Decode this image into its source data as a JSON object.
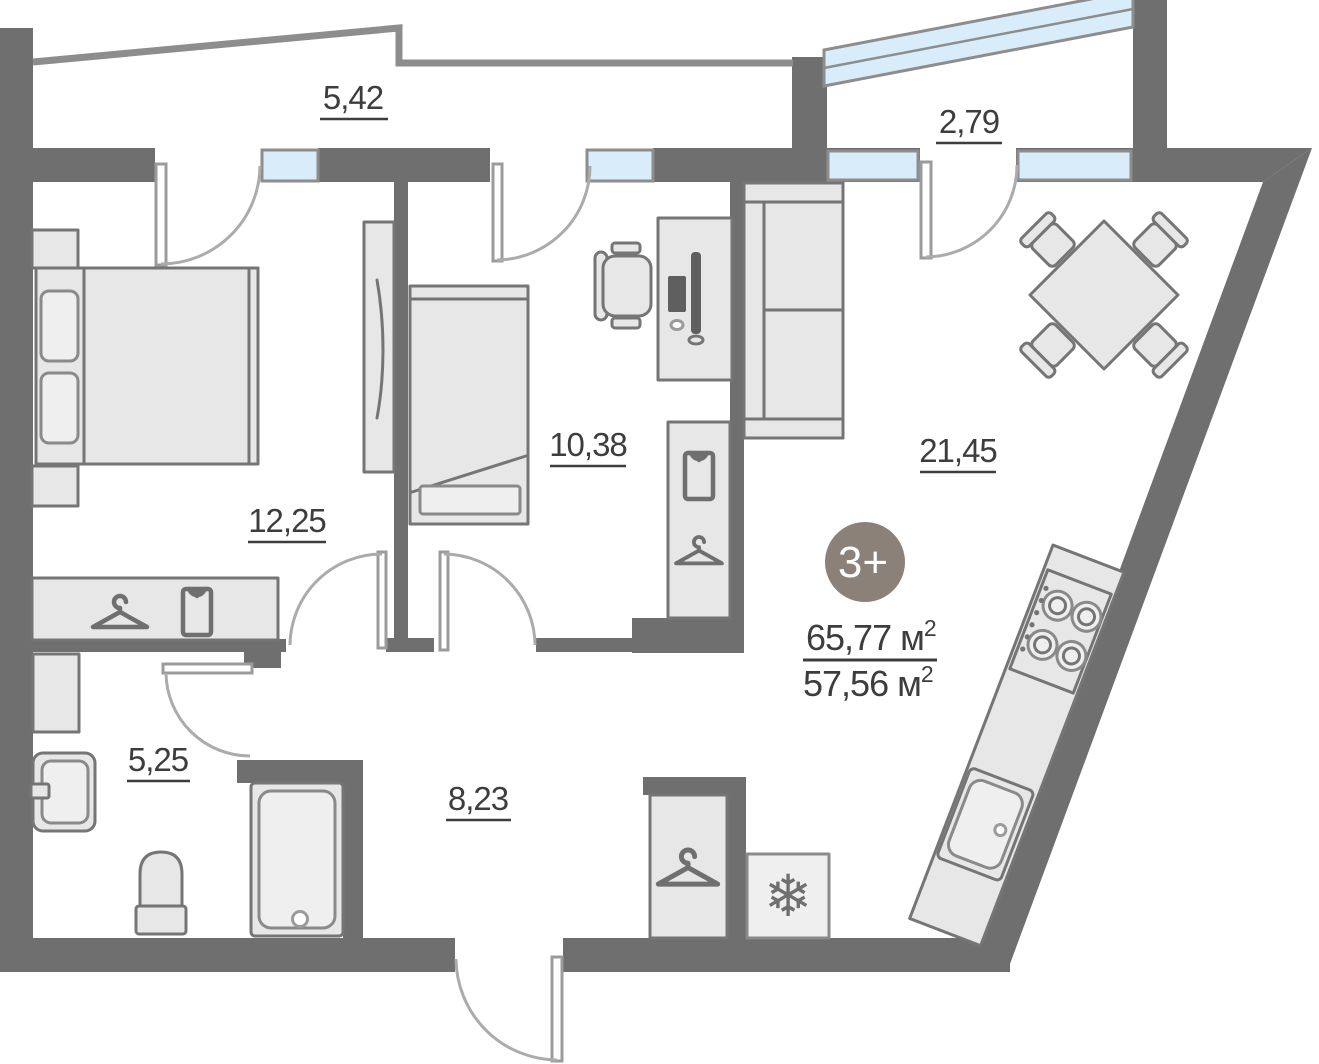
{
  "plan": {
    "badge": {
      "label": "3+",
      "bg": "#8b8178"
    },
    "area": {
      "total": "65,77",
      "living": "57,56",
      "unit": " м",
      "sup": "2"
    },
    "rooms": [
      {
        "id": "balcony-top-left",
        "label": "5,42"
      },
      {
        "id": "balcony-top-right",
        "label": "2,79"
      },
      {
        "id": "bedroom",
        "label": "12,25"
      },
      {
        "id": "kids-room",
        "label": "10,38"
      },
      {
        "id": "living-kitchen",
        "label": "21,45"
      },
      {
        "id": "bathroom",
        "label": "5,25"
      },
      {
        "id": "hallway",
        "label": "8,23"
      }
    ],
    "colors": {
      "wall": "#6f6f6f",
      "thin_wall": "#8d8d8d",
      "window_glass": "#d8ecf9",
      "furniture_fill": "#e7e7e7",
      "furniture_stroke": "#757575",
      "label": "#3d3d3d",
      "badge_bg": "#8b8178"
    }
  }
}
